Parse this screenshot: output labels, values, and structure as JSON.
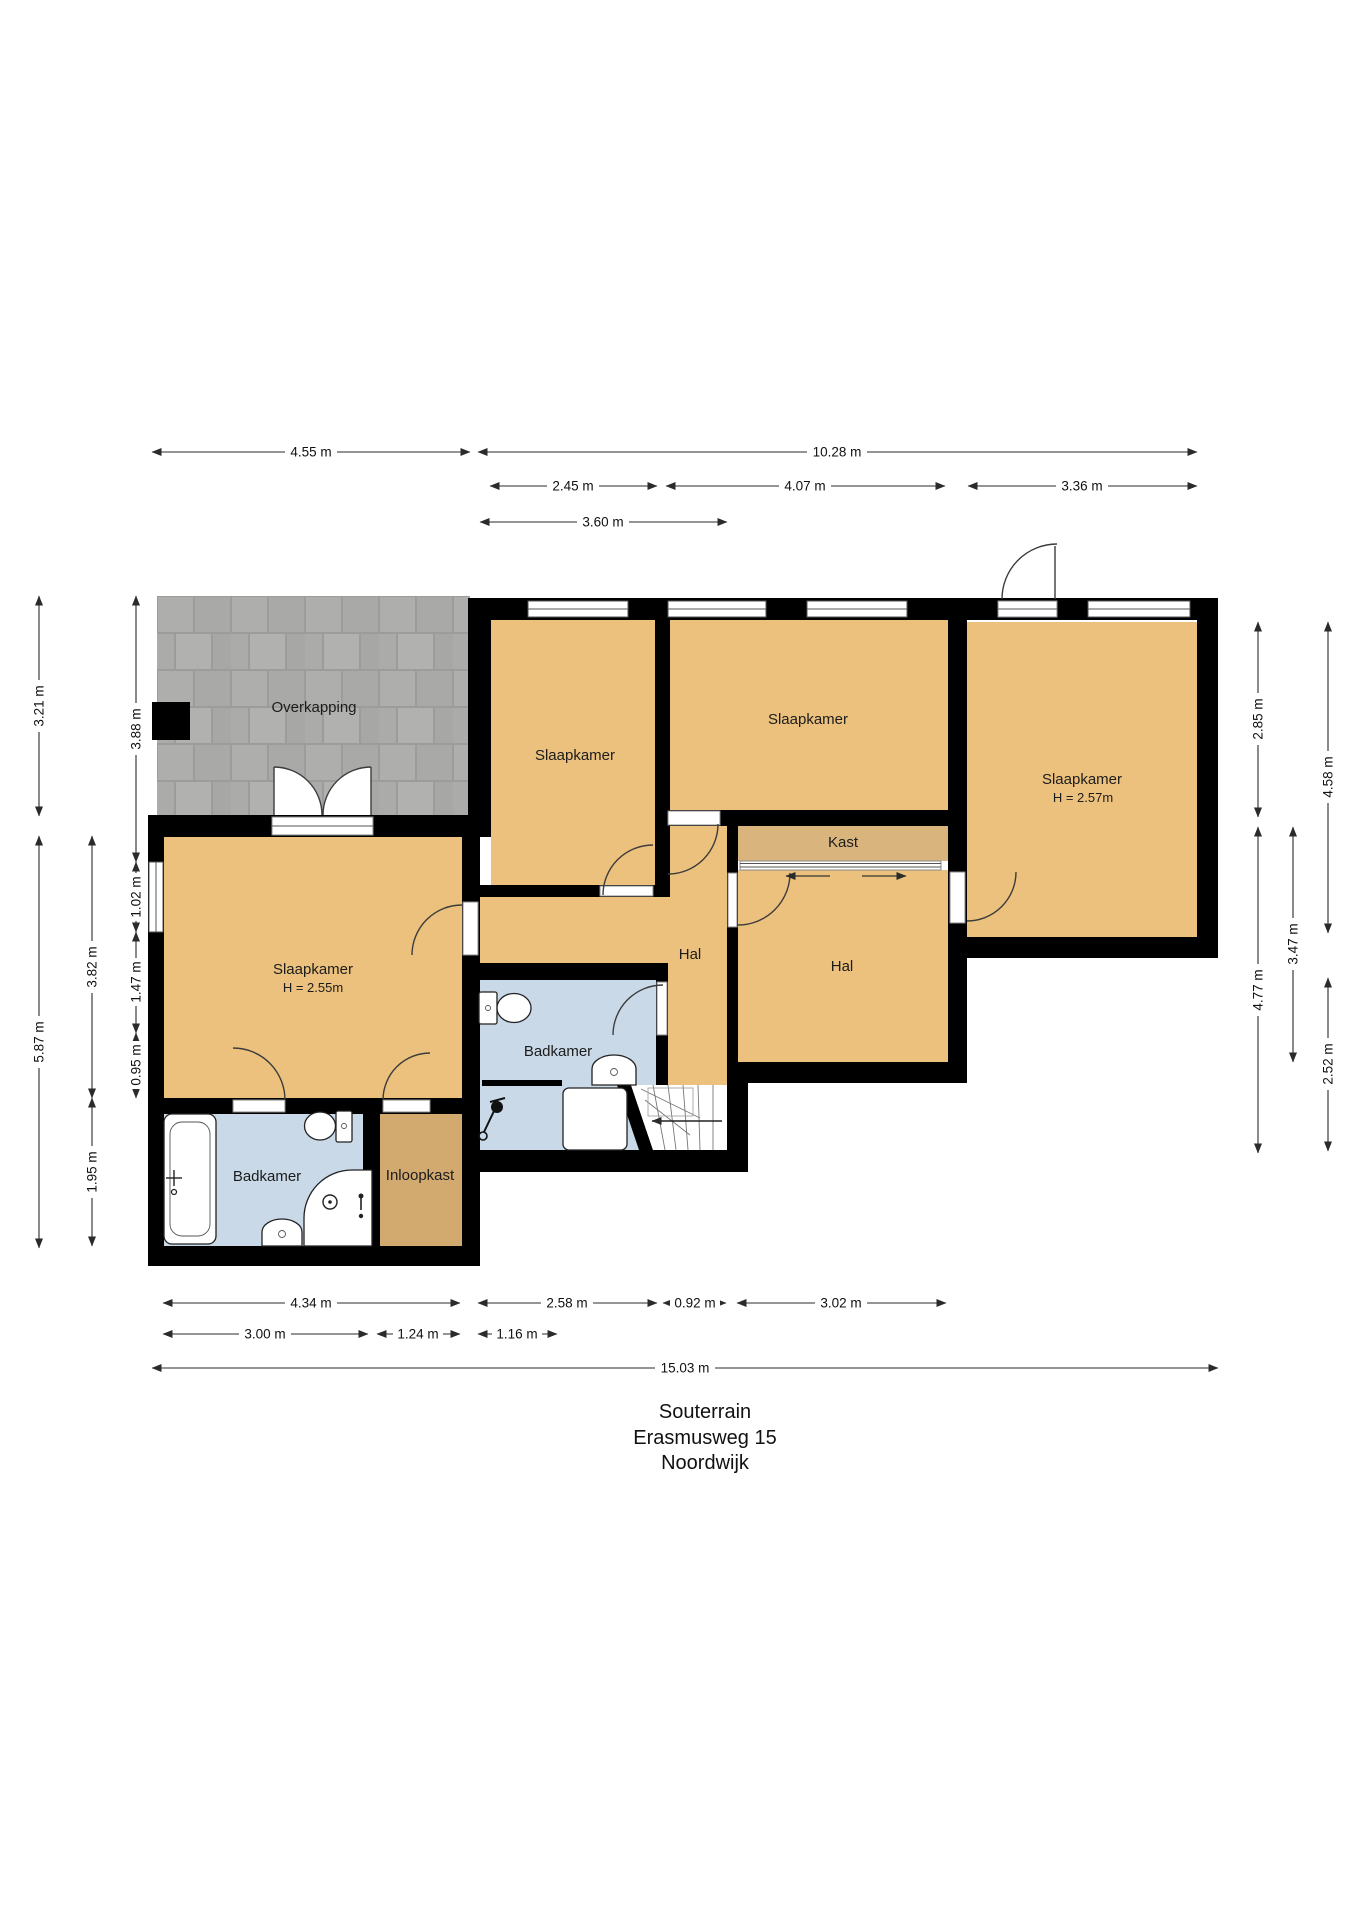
{
  "title": {
    "line1": "Souterrain",
    "line2": "Erasmusweg 15",
    "line3": "Noordwijk"
  },
  "rooms": {
    "overkapping": {
      "label": "Overkapping"
    },
    "slaapkamer_top_left": {
      "label": "Slaapkamer"
    },
    "slaapkamer_top_mid": {
      "label": "Slaapkamer"
    },
    "slaapkamer_right": {
      "label": "Slaapkamer",
      "height_note": "H = 2.57m"
    },
    "slaapkamer_left": {
      "label": "Slaapkamer",
      "height_note": "H = 2.55m"
    },
    "kast": {
      "label": "Kast"
    },
    "hal_middle": {
      "label": "Hal"
    },
    "hal_right": {
      "label": "Hal"
    },
    "badkamer_middle": {
      "label": "Badkamer"
    },
    "badkamer_left": {
      "label": "Badkamer"
    },
    "inloopkast": {
      "label": "Inloopkast"
    }
  },
  "dimensions": {
    "top": [
      "4.55 m",
      "10.28 m",
      "2.45 m",
      "4.07 m",
      "3.36 m",
      "3.60 m"
    ],
    "left": [
      "3.21 m",
      "5.87 m",
      "3.82 m",
      "1.95 m",
      "3.88 m",
      "1.02 m",
      "1.47 m",
      "0.95 m"
    ],
    "right": [
      "2.85 m",
      "4.77 m",
      "3.47 m",
      "4.58 m",
      "2.52 m"
    ],
    "bottom": [
      "4.34 m",
      "2.58 m",
      "0.92 m",
      "3.02 m",
      "3.00 m",
      "1.24 m",
      "1.16 m",
      "15.03 m"
    ]
  },
  "colors": {
    "wall": "#000000",
    "room_floor": "#ecc17d",
    "closet_floor": "#d9b47d",
    "walk_in_closet_floor": "#d2a96f",
    "bathroom_floor": "#c9d9e7",
    "paving_tile": "#aeaeac",
    "paving_joint": "#9c9c9a"
  }
}
